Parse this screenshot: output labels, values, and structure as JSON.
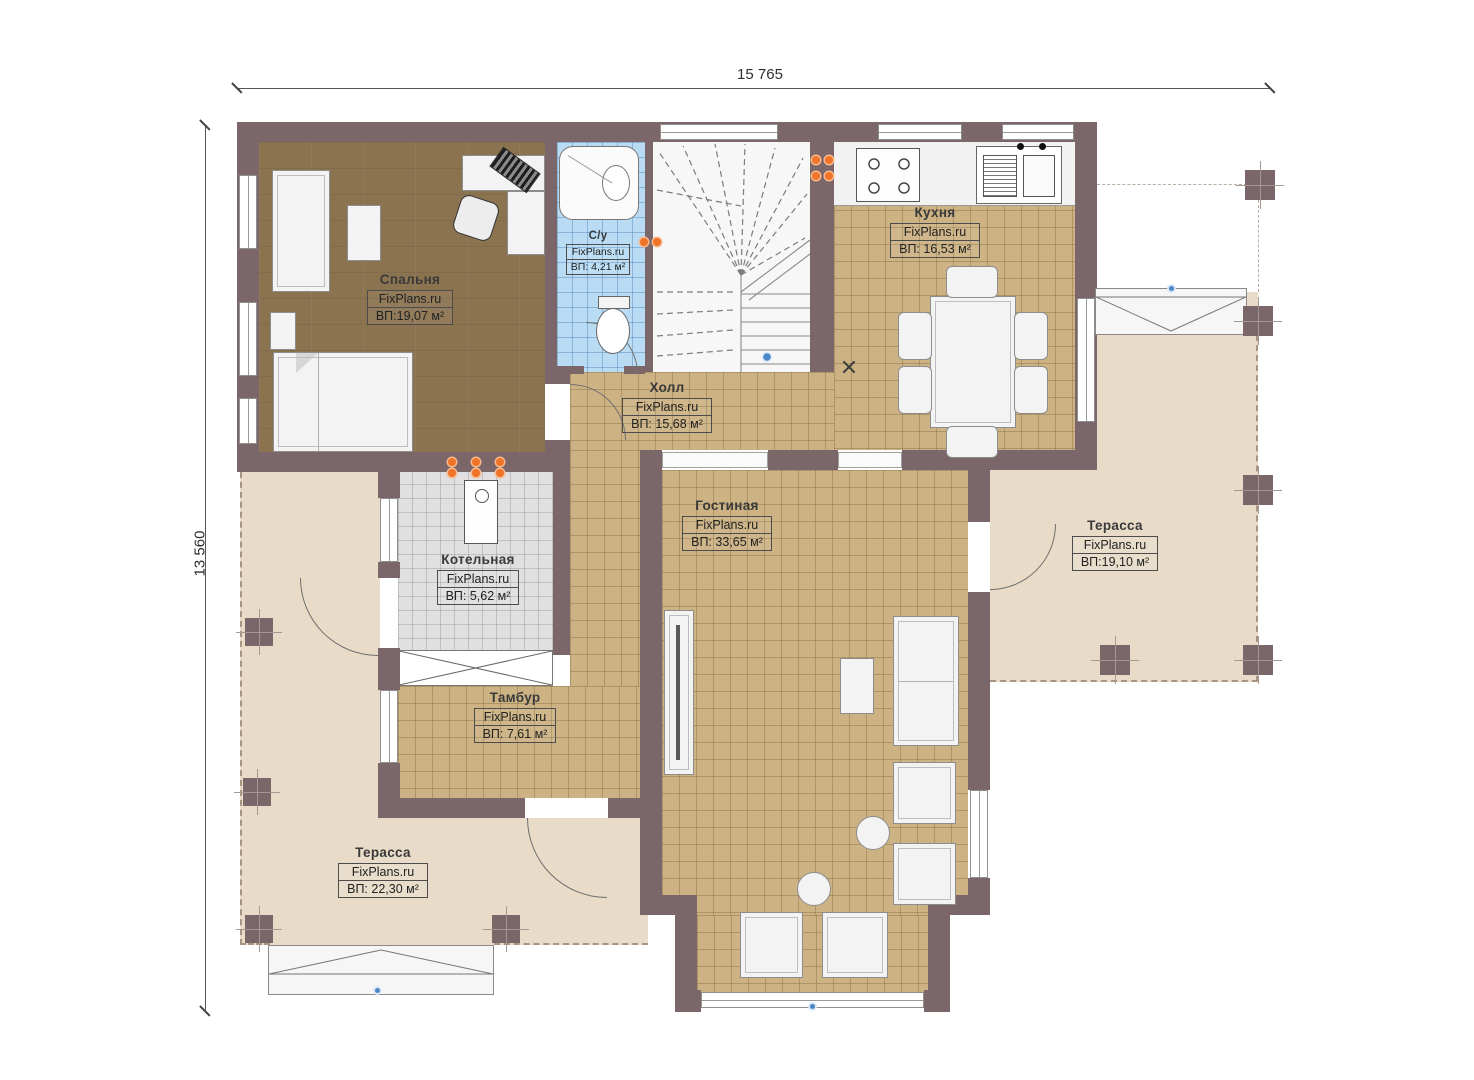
{
  "watermark": "FixPlans.ru",
  "dimensions": {
    "width": "15 765",
    "height": "13 560"
  },
  "rooms": [
    {
      "id": "bedroom",
      "name": "Спальня",
      "area": "ВП:19,07 м²"
    },
    {
      "id": "bathroom",
      "name": "С/у",
      "area": "ВП: 4,21 м²"
    },
    {
      "id": "kitchen",
      "name": "Кухня",
      "area": "ВП: 16,53 м²"
    },
    {
      "id": "hall",
      "name": "Холл",
      "area": "ВП: 15,68 м²"
    },
    {
      "id": "living-room",
      "name": "Гостиная",
      "area": "ВП: 33,65 м²"
    },
    {
      "id": "boiler-room",
      "name": "Котельная",
      "area": "ВП: 5,62 м²"
    },
    {
      "id": "vestibule",
      "name": "Тамбур",
      "area": "ВП: 7,61 м²"
    },
    {
      "id": "terrace-right",
      "name": "Терасса",
      "area": "ВП:19,10 м²"
    },
    {
      "id": "terrace-left",
      "name": "Терасса",
      "area": "ВП: 22,30 м²"
    }
  ],
  "colors": {
    "wall": "#7b6769",
    "tile_floor": "#cdb384",
    "wood_floor": "#8b7350",
    "bath_floor": "#b9dcf4",
    "boiler_floor": "#e0e0e0",
    "terrace_floor": "#e8dcc8",
    "utility_orange": "#f0732a",
    "marker_blue": "#4a86c8"
  }
}
